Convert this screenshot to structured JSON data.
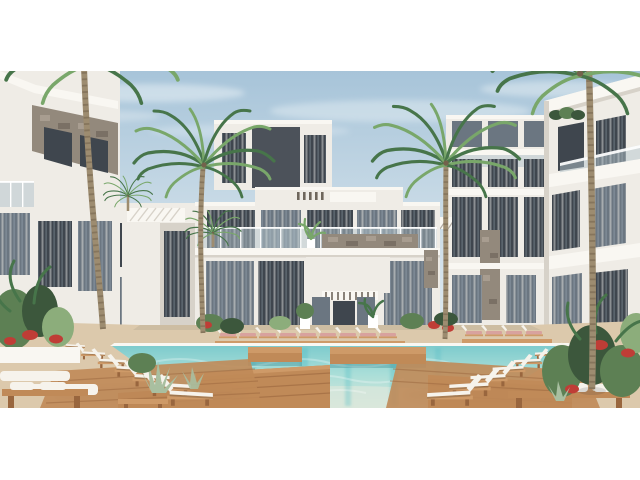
{
  "scene": {
    "type": "3d-architectural-rendering",
    "description": "Sunny courtyard view of a modern white resort apartment complex with stone-clad accents, tall palm trees, and a turquoise swimming pool crossed by wooden platforms and lined with rows of white sun loungers, benches with towels and tropical planting. The render sits between white letterbox bands.",
    "setting": {
      "sky": "clear light blue with soft clouds",
      "time_of_day": "midday"
    },
    "buildings": {
      "center": "two-storey white block with glass balcony balustrade, pergola slats and stone-clad feature walls over a glazed ground floor entrance",
      "left": "angled white foreground wing with grey-brown stone-clad upper facade and dark glazing",
      "right": "angled white foreground wing with stacked balconies and roof planters",
      "background": "taller three-storey wings with dark accent panels and slatted pergolas"
    },
    "pool": {
      "water_color_name": "turquoise",
      "features": "wooden swim platforms and walkways crossing the pool, light refraction streaks in the water"
    },
    "furniture": {
      "left_lounger_count": 7,
      "right_lounger_count": 7,
      "far_edge_lounger_count": 9,
      "benches_with_towels": 2
    },
    "vegetation": {
      "tall_palms": 4,
      "small_palms": 2,
      "shrubs": "tropical plants, agaves and red flowering bushes in white planters"
    }
  },
  "palette": {
    "sky_top": "#a7c4d9",
    "sky_mid": "#c8dae6",
    "sky_low": "#e0eaef",
    "cloud": "#eef4f7",
    "wall_white": "#efece6",
    "wall_bright": "#f9f7f2",
    "wall_shade": "#d7d2c9",
    "stone": "#93897c",
    "stone_dark": "#7a7065",
    "stone_light": "#a89d90",
    "win_dark": "#3f464e",
    "win_mid": "#6b7681",
    "win_light": "#9fb0ba",
    "curtain": "#d8d8d5",
    "glass": "#b6c6ce",
    "panel_dark": "#4c525a",
    "slat_dark": "#6e665c",
    "sand": "#dcc9ac",
    "sand_dark": "#c7b191",
    "wood": "#c08a58",
    "wood_mid": "#ce9a68",
    "wood_dark": "#99663e",
    "pool_far": "#7ecbcd",
    "pool_mid": "#a9ded8",
    "pool_near": "#d9e7db",
    "pool_streak": "#49b9c2",
    "cushion": "#f6f3ec",
    "pink_cushion": "#d8a29e",
    "green": "#5d8054",
    "green_dark": "#3c573c",
    "green_light": "#8cad7b",
    "agave": "#a9bfa0",
    "flower_red": "#bf3d36",
    "palm_green": "#47754a",
    "palm_green_light": "#79a76a",
    "trunk": "#9d8c70",
    "trunk_dark": "#73624c",
    "letterbox": "#ffffff"
  }
}
